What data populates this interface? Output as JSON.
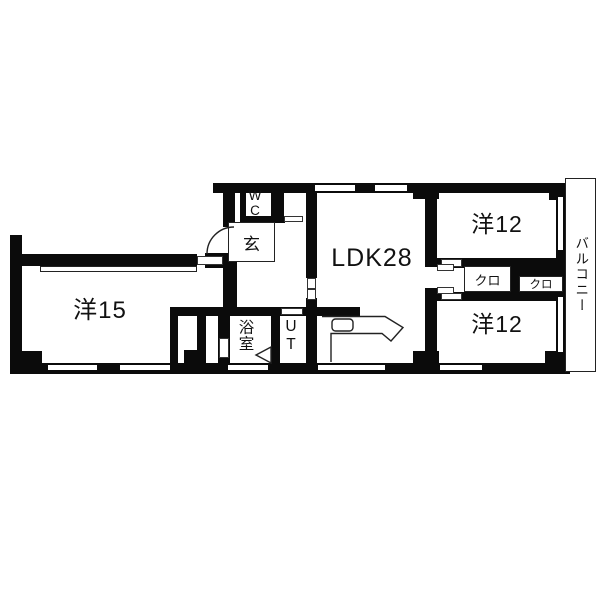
{
  "floor_plan": {
    "labels": {
      "west15": "洋15",
      "ldk": "LDK28",
      "west12_upper": "洋12",
      "west12_lower": "洋12",
      "closet_a": "クロ",
      "closet_b": "クロ",
      "entrance": "玄",
      "wc": "WC",
      "bath": "浴室",
      "utility": "UT",
      "balcony": "バルコニー"
    },
    "colors": {
      "wall": "#0b0b0b",
      "floor": "#ffffff"
    }
  }
}
